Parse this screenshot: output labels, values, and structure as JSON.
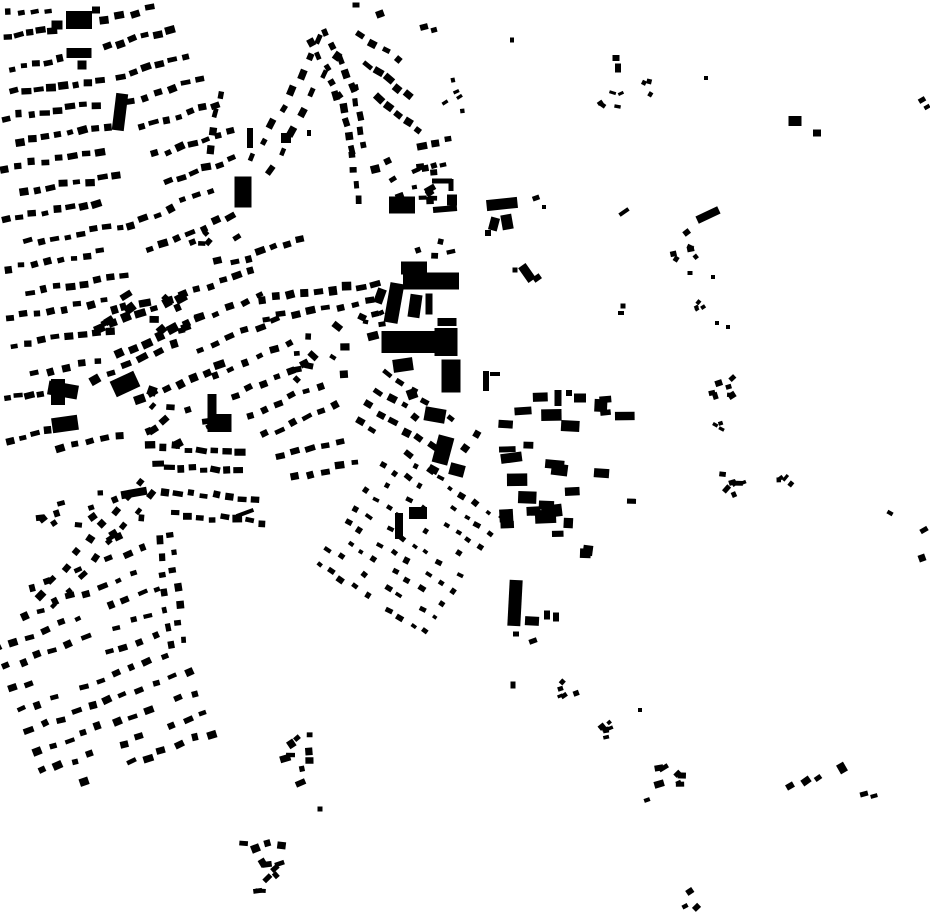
{
  "canvas": {
    "width": 930,
    "height": 924
  },
  "colors": {
    "background": "#ffffff",
    "building": "#000000"
  },
  "seed": 7,
  "map": {
    "description": "figure-ground building footprint map",
    "singles": [
      [
        79,
        20,
        26,
        18,
        0
      ],
      [
        57,
        25,
        11,
        9,
        0
      ],
      [
        96,
        10,
        8,
        7,
        0
      ],
      [
        79,
        53,
        25,
        10,
        0
      ],
      [
        82,
        65,
        9,
        9,
        0
      ],
      [
        120,
        112,
        12,
        37,
        7
      ],
      [
        243,
        192,
        17,
        31,
        0
      ],
      [
        250,
        138,
        6,
        20,
        0
      ],
      [
        286,
        138,
        10,
        10,
        0
      ],
      [
        309,
        133,
        4,
        6,
        0
      ],
      [
        356,
        5,
        7,
        5,
        0
      ],
      [
        380,
        14,
        8,
        7,
        -20
      ],
      [
        424,
        27,
        8,
        6,
        -15
      ],
      [
        434,
        30,
        6,
        5,
        -15
      ],
      [
        512,
        40,
        4,
        5,
        0
      ],
      [
        402,
        205,
        26,
        17,
        0
      ],
      [
        442,
        181,
        20,
        5,
        0
      ],
      [
        451,
        185,
        5,
        12,
        0
      ],
      [
        430,
        189,
        11,
        6,
        -30
      ],
      [
        445,
        209,
        24,
        6,
        -5
      ],
      [
        452,
        200,
        10,
        11,
        0
      ],
      [
        502,
        204,
        31,
        11,
        -6
      ],
      [
        494,
        224,
        9,
        13,
        15
      ],
      [
        507,
        222,
        11,
        15,
        -10
      ],
      [
        488,
        233,
        6,
        6,
        0
      ],
      [
        536,
        198,
        7,
        5,
        -20
      ],
      [
        544,
        207,
        4,
        4,
        0
      ],
      [
        527,
        273,
        9,
        18,
        -35
      ],
      [
        537,
        278,
        8,
        6,
        -35
      ],
      [
        515,
        270,
        5,
        5,
        0
      ],
      [
        414,
        268,
        26,
        13,
        0
      ],
      [
        431,
        281,
        56,
        17,
        0
      ],
      [
        380,
        296,
        9,
        15,
        20
      ],
      [
        394,
        303,
        14,
        40,
        10
      ],
      [
        415,
        306,
        12,
        23,
        8
      ],
      [
        429,
        304,
        7,
        21,
        0
      ],
      [
        447,
        322,
        19,
        8,
        0
      ],
      [
        373,
        336,
        11,
        8,
        -15
      ],
      [
        409,
        342,
        55,
        22,
        0
      ],
      [
        446,
        342,
        23,
        28,
        0
      ],
      [
        403,
        365,
        20,
        13,
        -8
      ],
      [
        451,
        376,
        19,
        33,
        0
      ],
      [
        412,
        394,
        10,
        10,
        -20
      ],
      [
        435,
        415,
        21,
        14,
        10
      ],
      [
        443,
        450,
        16,
        28,
        15
      ],
      [
        457,
        470,
        15,
        12,
        15
      ],
      [
        486,
        381,
        6,
        20,
        0
      ],
      [
        495,
        374,
        10,
        4,
        0
      ],
      [
        63,
        390,
        30,
        14,
        10
      ],
      [
        58,
        392,
        14,
        26,
        0
      ],
      [
        65,
        424,
        26,
        15,
        -8
      ],
      [
        125,
        384,
        26,
        17,
        -25
      ],
      [
        152,
        391,
        9,
        9,
        20
      ],
      [
        212,
        413,
        9,
        38,
        0
      ],
      [
        224,
        423,
        15,
        18,
        0
      ],
      [
        134,
        493,
        26,
        8,
        -10
      ],
      [
        245,
        513,
        18,
        4,
        -20
      ],
      [
        399,
        526,
        8,
        26,
        0
      ],
      [
        418,
        513,
        18,
        12,
        0
      ],
      [
        558,
        398,
        7,
        16,
        0
      ],
      [
        569,
        393,
        6,
        6,
        0
      ],
      [
        580,
        398,
        12,
        9,
        0
      ],
      [
        515,
        603,
        13,
        46,
        3
      ],
      [
        532,
        621,
        14,
        9,
        3
      ],
      [
        547,
        615,
        6,
        9,
        0
      ],
      [
        556,
        617,
        6,
        9,
        0
      ],
      [
        513,
        685,
        5,
        7,
        0
      ],
      [
        516,
        634,
        6,
        5,
        0
      ],
      [
        533,
        641,
        8,
        5,
        -20
      ],
      [
        616,
        58,
        7,
        6,
        0
      ],
      [
        618,
        68,
        6,
        9,
        0
      ],
      [
        706,
        78,
        4,
        4,
        0
      ],
      [
        795,
        121,
        13,
        10,
        0
      ],
      [
        817,
        133,
        8,
        7,
        0
      ],
      [
        624,
        212,
        11,
        4,
        -35
      ],
      [
        708,
        215,
        24,
        8,
        -25
      ],
      [
        690,
        273,
        5,
        4,
        0
      ],
      [
        713,
        277,
        4,
        4,
        0
      ],
      [
        623,
        306,
        5,
        5,
        0
      ],
      [
        621,
        313,
        6,
        4,
        0
      ],
      [
        717,
        323,
        4,
        4,
        0
      ],
      [
        728,
        327,
        4,
        4,
        0
      ],
      [
        922,
        100,
        7,
        5,
        -30
      ],
      [
        927,
        107,
        6,
        4,
        -30
      ],
      [
        890,
        513,
        6,
        4,
        30
      ],
      [
        924,
        530,
        8,
        5,
        -30
      ],
      [
        922,
        558,
        7,
        7,
        -20
      ],
      [
        790,
        786,
        8,
        6,
        -30
      ],
      [
        806,
        781,
        9,
        7,
        -35
      ],
      [
        818,
        778,
        7,
        5,
        -35
      ],
      [
        842,
        768,
        8,
        10,
        -30
      ],
      [
        864,
        794,
        8,
        5,
        -15
      ],
      [
        874,
        796,
        7,
        4,
        -15
      ],
      [
        647,
        800,
        6,
        4,
        -20
      ],
      [
        640,
        710,
        4,
        4,
        0
      ],
      [
        320,
        809,
        5,
        5,
        0
      ]
    ],
    "rows": [
      [
        8,
        14,
        48,
        10,
        4,
        7,
        5
      ],
      [
        8,
        38,
        52,
        30,
        5,
        8,
        6
      ],
      [
        12,
        68,
        60,
        60,
        5,
        8,
        6
      ],
      [
        14,
        92,
        100,
        80,
        8,
        8,
        6
      ],
      [
        6,
        118,
        96,
        104,
        8,
        8,
        6
      ],
      [
        20,
        142,
        108,
        128,
        8,
        8,
        6
      ],
      [
        4,
        168,
        100,
        152,
        8,
        8,
        6
      ],
      [
        24,
        192,
        116,
        176,
        8,
        8,
        6
      ],
      [
        6,
        218,
        96,
        202,
        8,
        8,
        6
      ],
      [
        28,
        242,
        120,
        226,
        8,
        8,
        6
      ],
      [
        8,
        268,
        100,
        252,
        8,
        8,
        6
      ],
      [
        30,
        292,
        124,
        276,
        8,
        8,
        6
      ],
      [
        10,
        318,
        104,
        300,
        8,
        8,
        6
      ],
      [
        14,
        345,
        110,
        330,
        8,
        8,
        6
      ],
      [
        34,
        372,
        98,
        362,
        5,
        8,
        6
      ],
      [
        8,
        400,
        40,
        393,
        4,
        8,
        6
      ],
      [
        10,
        440,
        48,
        432,
        4,
        8,
        6
      ],
      [
        60,
        448,
        120,
        438,
        5,
        8,
        6
      ],
      [
        104,
        20,
        150,
        8,
        4,
        8,
        6
      ],
      [
        108,
        48,
        170,
        30,
        6,
        8,
        6
      ],
      [
        120,
        75,
        185,
        55,
        6,
        8,
        6
      ],
      [
        130,
        100,
        200,
        80,
        6,
        8,
        6
      ],
      [
        142,
        128,
        215,
        105,
        7,
        8,
        6
      ],
      [
        155,
        155,
        230,
        130,
        7,
        8,
        6
      ],
      [
        168,
        180,
        232,
        160,
        6,
        8,
        6
      ],
      [
        220,
        95,
        212,
        150,
        4,
        7,
        6
      ],
      [
        253,
        158,
        320,
        40,
        8,
        8,
        6
      ],
      [
        270,
        170,
        335,
        55,
        7,
        8,
        6
      ],
      [
        312,
        42,
        340,
        95,
        5,
        8,
        6
      ],
      [
        326,
        32,
        352,
        88,
        5,
        8,
        6
      ],
      [
        338,
        95,
        352,
        150,
        5,
        8,
        6
      ],
      [
        353,
        88,
        363,
        145,
        5,
        7,
        6
      ],
      [
        350,
        155,
        357,
        200,
        4,
        7,
        6
      ],
      [
        360,
        35,
        398,
        60,
        4,
        8,
        6
      ],
      [
        368,
        65,
        408,
        95,
        5,
        8,
        6
      ],
      [
        378,
        100,
        418,
        130,
        5,
        8,
        6
      ],
      [
        422,
        146,
        448,
        139,
        3,
        8,
        6
      ],
      [
        425,
        168,
        443,
        165,
        3,
        6,
        5
      ],
      [
        262,
        300,
        375,
        283,
        9,
        9,
        7
      ],
      [
        266,
        318,
        370,
        301,
        8,
        8,
        6
      ],
      [
        100,
        330,
        180,
        296,
        7,
        9,
        7
      ],
      [
        120,
        355,
        200,
        318,
        7,
        9,
        7
      ],
      [
        95,
        380,
        175,
        346,
        6,
        9,
        7
      ],
      [
        140,
        400,
        220,
        366,
        7,
        9,
        7
      ],
      [
        170,
        300,
        250,
        270,
        7,
        8,
        6
      ],
      [
        185,
        325,
        260,
        296,
        6,
        8,
        6
      ],
      [
        200,
        350,
        275,
        320,
        6,
        8,
        6
      ],
      [
        215,
        375,
        290,
        345,
        6,
        8,
        6
      ],
      [
        235,
        395,
        305,
        365,
        6,
        8,
        6
      ],
      [
        250,
        415,
        320,
        385,
        6,
        8,
        6
      ],
      [
        265,
        435,
        335,
        405,
        6,
        8,
        6
      ],
      [
        150,
        250,
        230,
        216,
        7,
        8,
        6
      ],
      [
        130,
        225,
        210,
        190,
        7,
        8,
        6
      ],
      [
        235,
        262,
        300,
        240,
        6,
        8,
        6
      ],
      [
        150,
        446,
        240,
        452,
        8,
        9,
        6
      ],
      [
        158,
        466,
        238,
        472,
        8,
        9,
        6
      ],
      [
        165,
        492,
        255,
        500,
        8,
        8,
        6
      ],
      [
        175,
        515,
        262,
        522,
        8,
        8,
        6
      ],
      [
        280,
        455,
        340,
        441,
        5,
        8,
        6
      ],
      [
        295,
        478,
        355,
        463,
        5,
        8,
        6
      ],
      [
        140,
        482,
        40,
        595,
        9,
        8,
        6
      ],
      [
        152,
        495,
        54,
        606,
        8,
        7,
        5
      ],
      [
        170,
        535,
        182,
        640,
        7,
        7,
        6
      ],
      [
        158,
        540,
        169,
        645,
        7,
        7,
        6
      ]
    ],
    "grids": [
      [
        95,
        668,
        185,
        215,
        -20,
        17,
        22,
        8,
        6,
        0.22
      ],
      [
        410,
        540,
        140,
        150,
        33,
        14,
        17,
        6,
        5,
        0.25
      ],
      [
        415,
        430,
        120,
        80,
        33,
        15,
        18,
        8,
        6,
        0.3
      ]
    ],
    "scatters": [
      [
        565,
        470,
        82,
        88,
        30,
        9,
        22,
        5,
        13,
        0,
        8
      ],
      [
        404,
        182,
        40,
        30,
        12,
        5,
        10,
        4,
        8,
        -15,
        25
      ],
      [
        456,
        95,
        16,
        18,
        5,
        4,
        7,
        3,
        5,
        -20,
        30
      ],
      [
        610,
        99,
        14,
        9,
        5,
        4,
        7,
        3,
        5,
        0,
        40
      ],
      [
        649,
        89,
        10,
        8,
        3,
        4,
        6,
        3,
        5,
        0,
        40
      ],
      [
        686,
        248,
        14,
        18,
        6,
        4,
        8,
        3,
        6,
        0,
        40
      ],
      [
        703,
        305,
        10,
        12,
        4,
        4,
        6,
        3,
        4,
        -30,
        20
      ],
      [
        721,
        387,
        16,
        14,
        7,
        5,
        9,
        4,
        7,
        -20,
        30
      ],
      [
        719,
        420,
        8,
        10,
        3,
        4,
        6,
        3,
        5,
        0,
        30
      ],
      [
        728,
        485,
        17,
        15,
        7,
        4,
        8,
        3,
        6,
        -20,
        30
      ],
      [
        782,
        482,
        10,
        11,
        4,
        4,
        8,
        3,
        5,
        -30,
        30
      ],
      [
        303,
        760,
        22,
        27,
        9,
        5,
        11,
        4,
        9,
        -15,
        30
      ],
      [
        263,
        862,
        26,
        32,
        12,
        5,
        11,
        4,
        8,
        -15,
        30
      ],
      [
        565,
        690,
        12,
        10,
        5,
        4,
        8,
        3,
        6,
        -30,
        30
      ],
      [
        606,
        725,
        14,
        14,
        6,
        4,
        8,
        3,
        6,
        -30,
        30
      ],
      [
        668,
        775,
        16,
        14,
        7,
        5,
        10,
        4,
        7,
        -20,
        30
      ],
      [
        692,
        901,
        9,
        10,
        3,
        5,
        8,
        4,
        6,
        -30,
        20
      ],
      [
        95,
        520,
        55,
        28,
        14,
        5,
        9,
        4,
        7,
        -15,
        25
      ],
      [
        150,
        315,
        46,
        26,
        12,
        6,
        12,
        5,
        9,
        -25,
        30
      ],
      [
        175,
        420,
        40,
        25,
        10,
        5,
        10,
        4,
        8,
        -20,
        30
      ],
      [
        320,
        352,
        36,
        36,
        10,
        5,
        10,
        4,
        8,
        20,
        30
      ],
      [
        372,
        315,
        15,
        18,
        5,
        5,
        9,
        4,
        7,
        0,
        30
      ],
      [
        215,
        245,
        25,
        18,
        6,
        5,
        9,
        4,
        7,
        -25,
        30
      ],
      [
        435,
        248,
        22,
        10,
        4,
        5,
        9,
        4,
        6,
        0,
        20
      ]
    ]
  }
}
